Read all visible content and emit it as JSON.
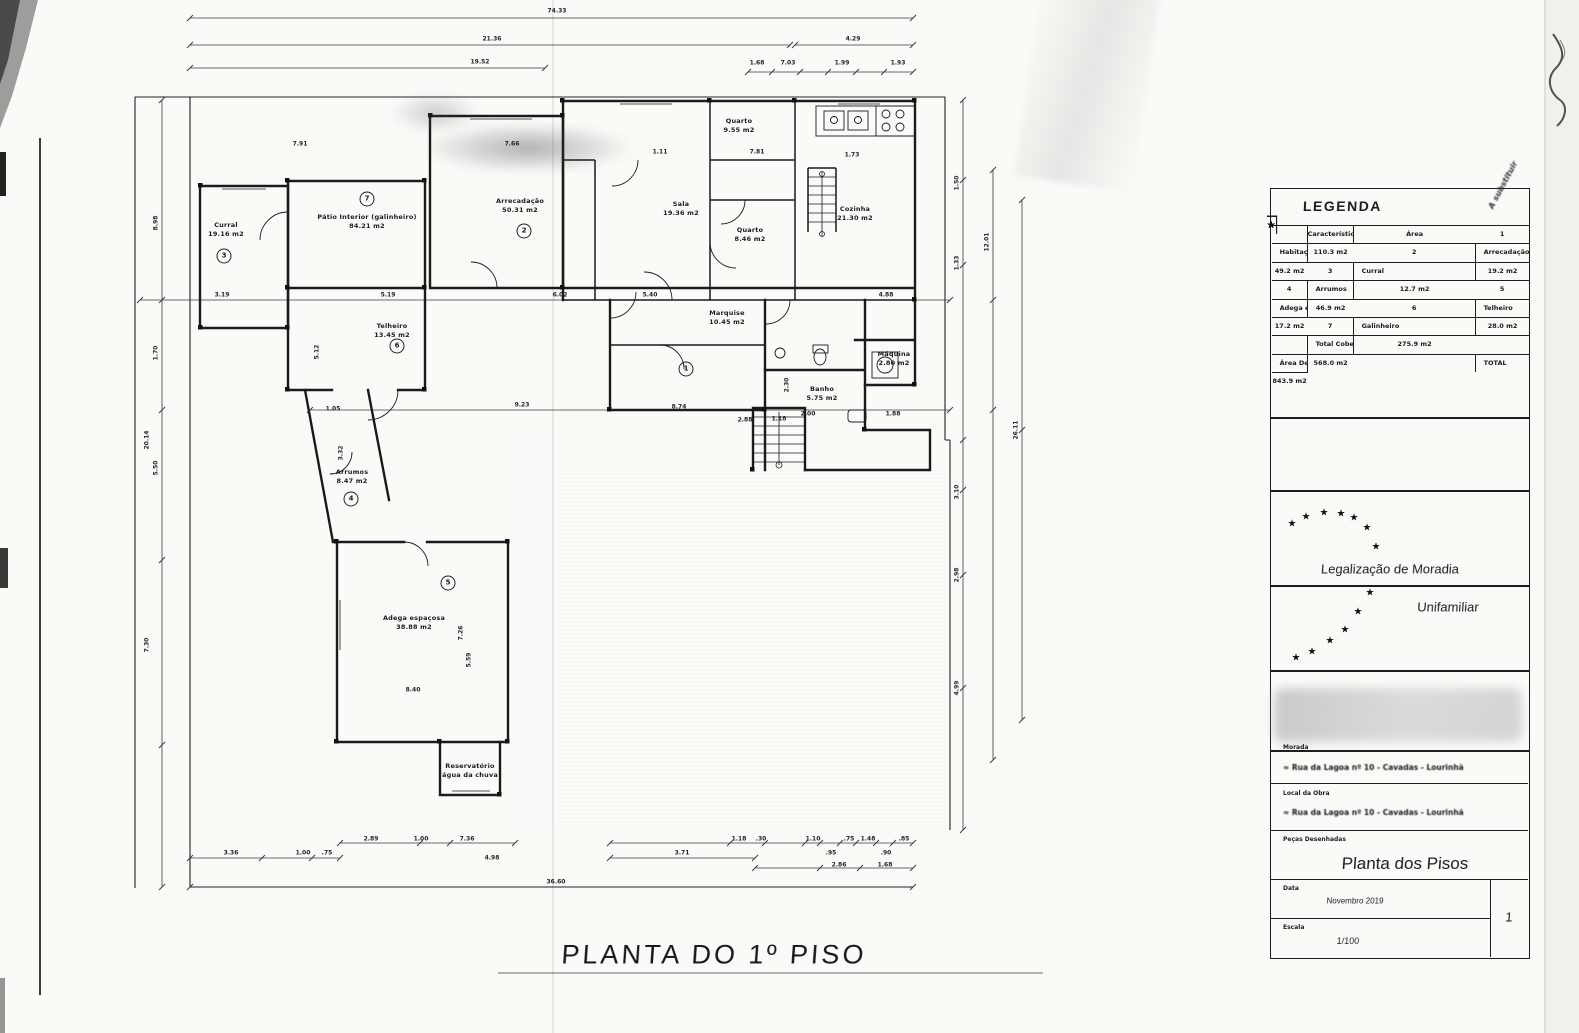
{
  "page": {
    "plan_title": "PLANTA DO 1º PISO",
    "note_diagonal": "A substituir"
  },
  "decor": {
    "star": "★"
  },
  "legend": {
    "title": "LEGENDA",
    "rows": [
      {
        "star": "★",
        "num": "",
        "name": "Características",
        "area": "Área"
      },
      {
        "star": "★",
        "num": "1",
        "name": "Habitação",
        "area": "110.3 m2"
      },
      {
        "star": "★",
        "num": "2",
        "name": "Arrecadação",
        "area": "49.2 m2"
      },
      {
        "star": "★",
        "num": "3",
        "name": "Curral",
        "area": "19.2 m2"
      },
      {
        "star": "★",
        "num": "4",
        "name": "Arrumos",
        "area": "12.7 m2"
      },
      {
        "star": "★",
        "num": "5",
        "name": "Adega espaçosa",
        "area": "46.9 m2"
      },
      {
        "star": "★",
        "num": "6",
        "name": "Telheiro",
        "area": "17.2 m2"
      },
      {
        "star": "★",
        "num": "7",
        "name": "Galinheiro",
        "area": "28.0 m2"
      },
      {
        "star": "★",
        "num": "",
        "name": "Total Coberta",
        "area": "275.9 m2"
      },
      {
        "star": "★",
        "num": "",
        "name": "Área Descoberta",
        "area": "568.0 m2"
      },
      {
        "star": "★",
        "num": "",
        "name": "TOTAL",
        "area": "843.9 m2"
      }
    ]
  },
  "stamp": {
    "line1": "Legalização de Moradia",
    "line2": "Unifamiliar"
  },
  "titleblock": {
    "morada_label": "Morada",
    "morada_value": "≈ Rua da Lagoa nº 10  -  Cavadas  -  Lourinhã",
    "local_label": "Local da Obra",
    "local_value": "≈ Rua da Lagoa nº 10  -  Cavadas  -  Lourinhã",
    "pecas_label": "Peças Desenhadas",
    "pecas_value": "Planta dos Pisos",
    "data_label": "Data",
    "data_value": "Novembro 2019",
    "escala_label": "Escala",
    "escala_value": "1/100",
    "sheet_number": "1"
  },
  "rooms": [
    {
      "name": "Curral",
      "area": "19.16 m2"
    },
    {
      "name": "Pátio Interior (galinheiro)",
      "area": "84.21 m2"
    },
    {
      "name": "Arrecadação",
      "area": "50.31 m2"
    },
    {
      "name": "Quarto",
      "area": "9.55 m2"
    },
    {
      "name": "Sala",
      "area": "19.36 m2"
    },
    {
      "name": "Quarto",
      "area": "8.46 m2"
    },
    {
      "name": "Cozinha",
      "area": "21.30 m2"
    },
    {
      "name": "Marquise",
      "area": "10.45 m2"
    },
    {
      "name": "Banho",
      "area": "5.75 m2"
    },
    {
      "name": "Máquina",
      "area": "2.80 m2"
    },
    {
      "name": "Telheiro",
      "area": "13.45 m2"
    },
    {
      "name": "Arrumos",
      "area": "8.47 m2"
    },
    {
      "name": "Adega espaçosa",
      "area": "38.88 m2"
    },
    {
      "name": "Reservatório",
      "area": "água da chuva"
    }
  ],
  "badges": [
    "1",
    "2",
    "3",
    "4",
    "5",
    "6",
    "7"
  ],
  "dims": [
    "74.33",
    "21.36",
    "19.52",
    "4.29",
    "1.68",
    "7.03",
    "1.99",
    "1.93",
    "7.91",
    "7.66",
    "1.11",
    "7.81",
    "1.73",
    "8.98",
    "1.70",
    "20.14",
    "5.50",
    "7.30",
    "3.19",
    "5.19",
    "6.02",
    "5.40",
    "4.88",
    "9.23",
    "8.74",
    "1.18",
    "2.00",
    "1.88",
    "5.12",
    "3.32",
    "7.26",
    "5.59",
    "8.40",
    "1.50",
    "12.01",
    "1.33",
    "26.11",
    "3.10",
    "2.98",
    "4.99",
    "2.89",
    "1.00",
    "7.36",
    "3.36",
    "1.00",
    ".75",
    "4.98",
    "36.60",
    "3.71",
    "1.18",
    ".30",
    "1.10",
    ".95",
    ".75",
    "1.48",
    ".90",
    ".85",
    "2.86",
    "1.68",
    "2.30",
    "2.88",
    "1.05"
  ]
}
